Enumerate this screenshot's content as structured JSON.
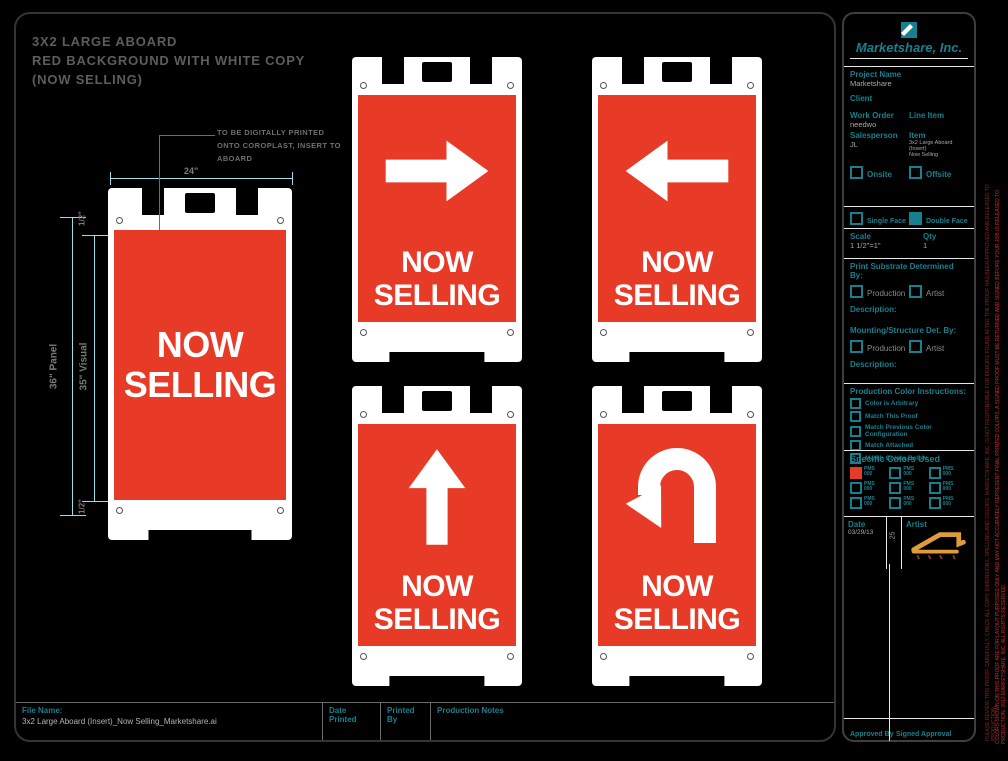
{
  "title": {
    "line1": "3X2 LARGE ABOARD",
    "line2": "RED BACKGROUND WITH WHITE COPY",
    "line3": "(NOW SELLING)"
  },
  "annotation": {
    "line1": "TO BE DIGITALLY PRINTED",
    "line2": "ONTO COROPLAST, INSERT TO",
    "line3": "ABOARD"
  },
  "dimensions": {
    "width": "24\"",
    "half_top": "1/2\"",
    "panel": "36\" Panel",
    "visual": "35\" Visual",
    "half_bottom": "1/2\""
  },
  "signs": [
    {
      "arrow": "none",
      "line1": "NOW",
      "line2": "SELLING"
    },
    {
      "arrow": "right",
      "line1": "NOW",
      "line2": "SELLING"
    },
    {
      "arrow": "left",
      "line1": "NOW",
      "line2": "SELLING"
    },
    {
      "arrow": "up",
      "line1": "NOW",
      "line2": "SELLING"
    },
    {
      "arrow": "u-turn",
      "line1": "NOW",
      "line2": "SELLING"
    }
  ],
  "sidebar": {
    "company": "Marketshare, Inc.",
    "project_name_label": "Project Name",
    "project_name": "Marketshare",
    "client_label": "Client",
    "client": "",
    "work_order_label": "Work Order",
    "work_order": "needwo",
    "line_item_label": "Line Item",
    "line_item": "",
    "salesperson_label": "Salesperson",
    "salesperson": "JL",
    "item_label": "Item",
    "item_line1": "3x2 Large Aboard (Insert)",
    "item_line2": "Now Selling",
    "onsite_label": "Onsite",
    "offsite_label": "Offsite",
    "single_face_label": "Single Face",
    "double_face_label": "Double Face",
    "single_face_checked": false,
    "double_face_checked": true,
    "scale_label": "Scale",
    "scale": "1 1/2\"=1\"",
    "qty_label": "Qty",
    "qty": "1",
    "print_substrate_label": "Print Substrate Determined By:",
    "production_label": "Production",
    "artist_label": "Artist",
    "description_label": "Description:",
    "mounting_label": "Mounting/Structure Det. By:",
    "color_instructions_label": "Production Color Instructions:",
    "color_options": [
      "Color is Arbitrary",
      "Match This Proof",
      "Match Previous Color Configuration",
      "Match Attached",
      "Match Colors Below"
    ],
    "specific_colors_label": "Specific Colors Used",
    "pms": [
      {
        "label": "PMS 000",
        "filled": true
      },
      {
        "label": "PMS 000",
        "filled": false
      },
      {
        "label": "PMS 000",
        "filled": false
      },
      {
        "label": "PMS 000",
        "filled": false
      },
      {
        "label": "PMS 000",
        "filled": false
      },
      {
        "label": "PMS 000",
        "filled": false
      },
      {
        "label": "PMS 000",
        "filled": false
      },
      {
        "label": "PMS 000",
        "filled": false
      },
      {
        "label": "PMS 000",
        "filled": false
      }
    ],
    "date_label": "Date",
    "date": "03/29/13",
    "scale_note": ".25",
    "artist_sig_label": "Artist",
    "approved_by_label": "Approved By",
    "signed_approval_label": "Signed Approval"
  },
  "footer": {
    "file_name_label": "File Name:",
    "file_name": "3x2 Large Aboard (Insert)_Now Selling_Marketshare.ai",
    "date_printed_label": "Date Printed",
    "printed_by_label": "Printed By",
    "production_notes_label": "Production Notes"
  },
  "edge_text": {
    "vertical_1": "PLEASE REVIEW THIS PROOF CAREFULLY. CHECK ALL COPY, DIMENSIONS, SPELLING AND COLORS. MARKETSHARE, INC. IS NOT RESPONSIBLE FOR ERRORS FOUND AFTER THE PROOF HAS BEEN APPROVED AND RELEASED TO PRODUCTION.",
    "vertical_2": "COLORS SHOWN ON THIS PROOF ARE FOR LAYOUT PURPOSES ONLY AND MAY NOT ACCURATELY REPRESENT FINAL PRINTED COLORS. A SIGNED PROOF MUST BE RETURNED AND SIGNED BEFORE YOUR JOB IS RELEASED TO PRODUCTION. 2013 MARKETSHARE, INC. ALL RIGHTS RESERVED."
  },
  "colors": {
    "sign_red": "#E73B28",
    "teal": "#17808E",
    "dimension_cyan": "#9ADCEB",
    "signature_orange": "#E09B3A"
  }
}
